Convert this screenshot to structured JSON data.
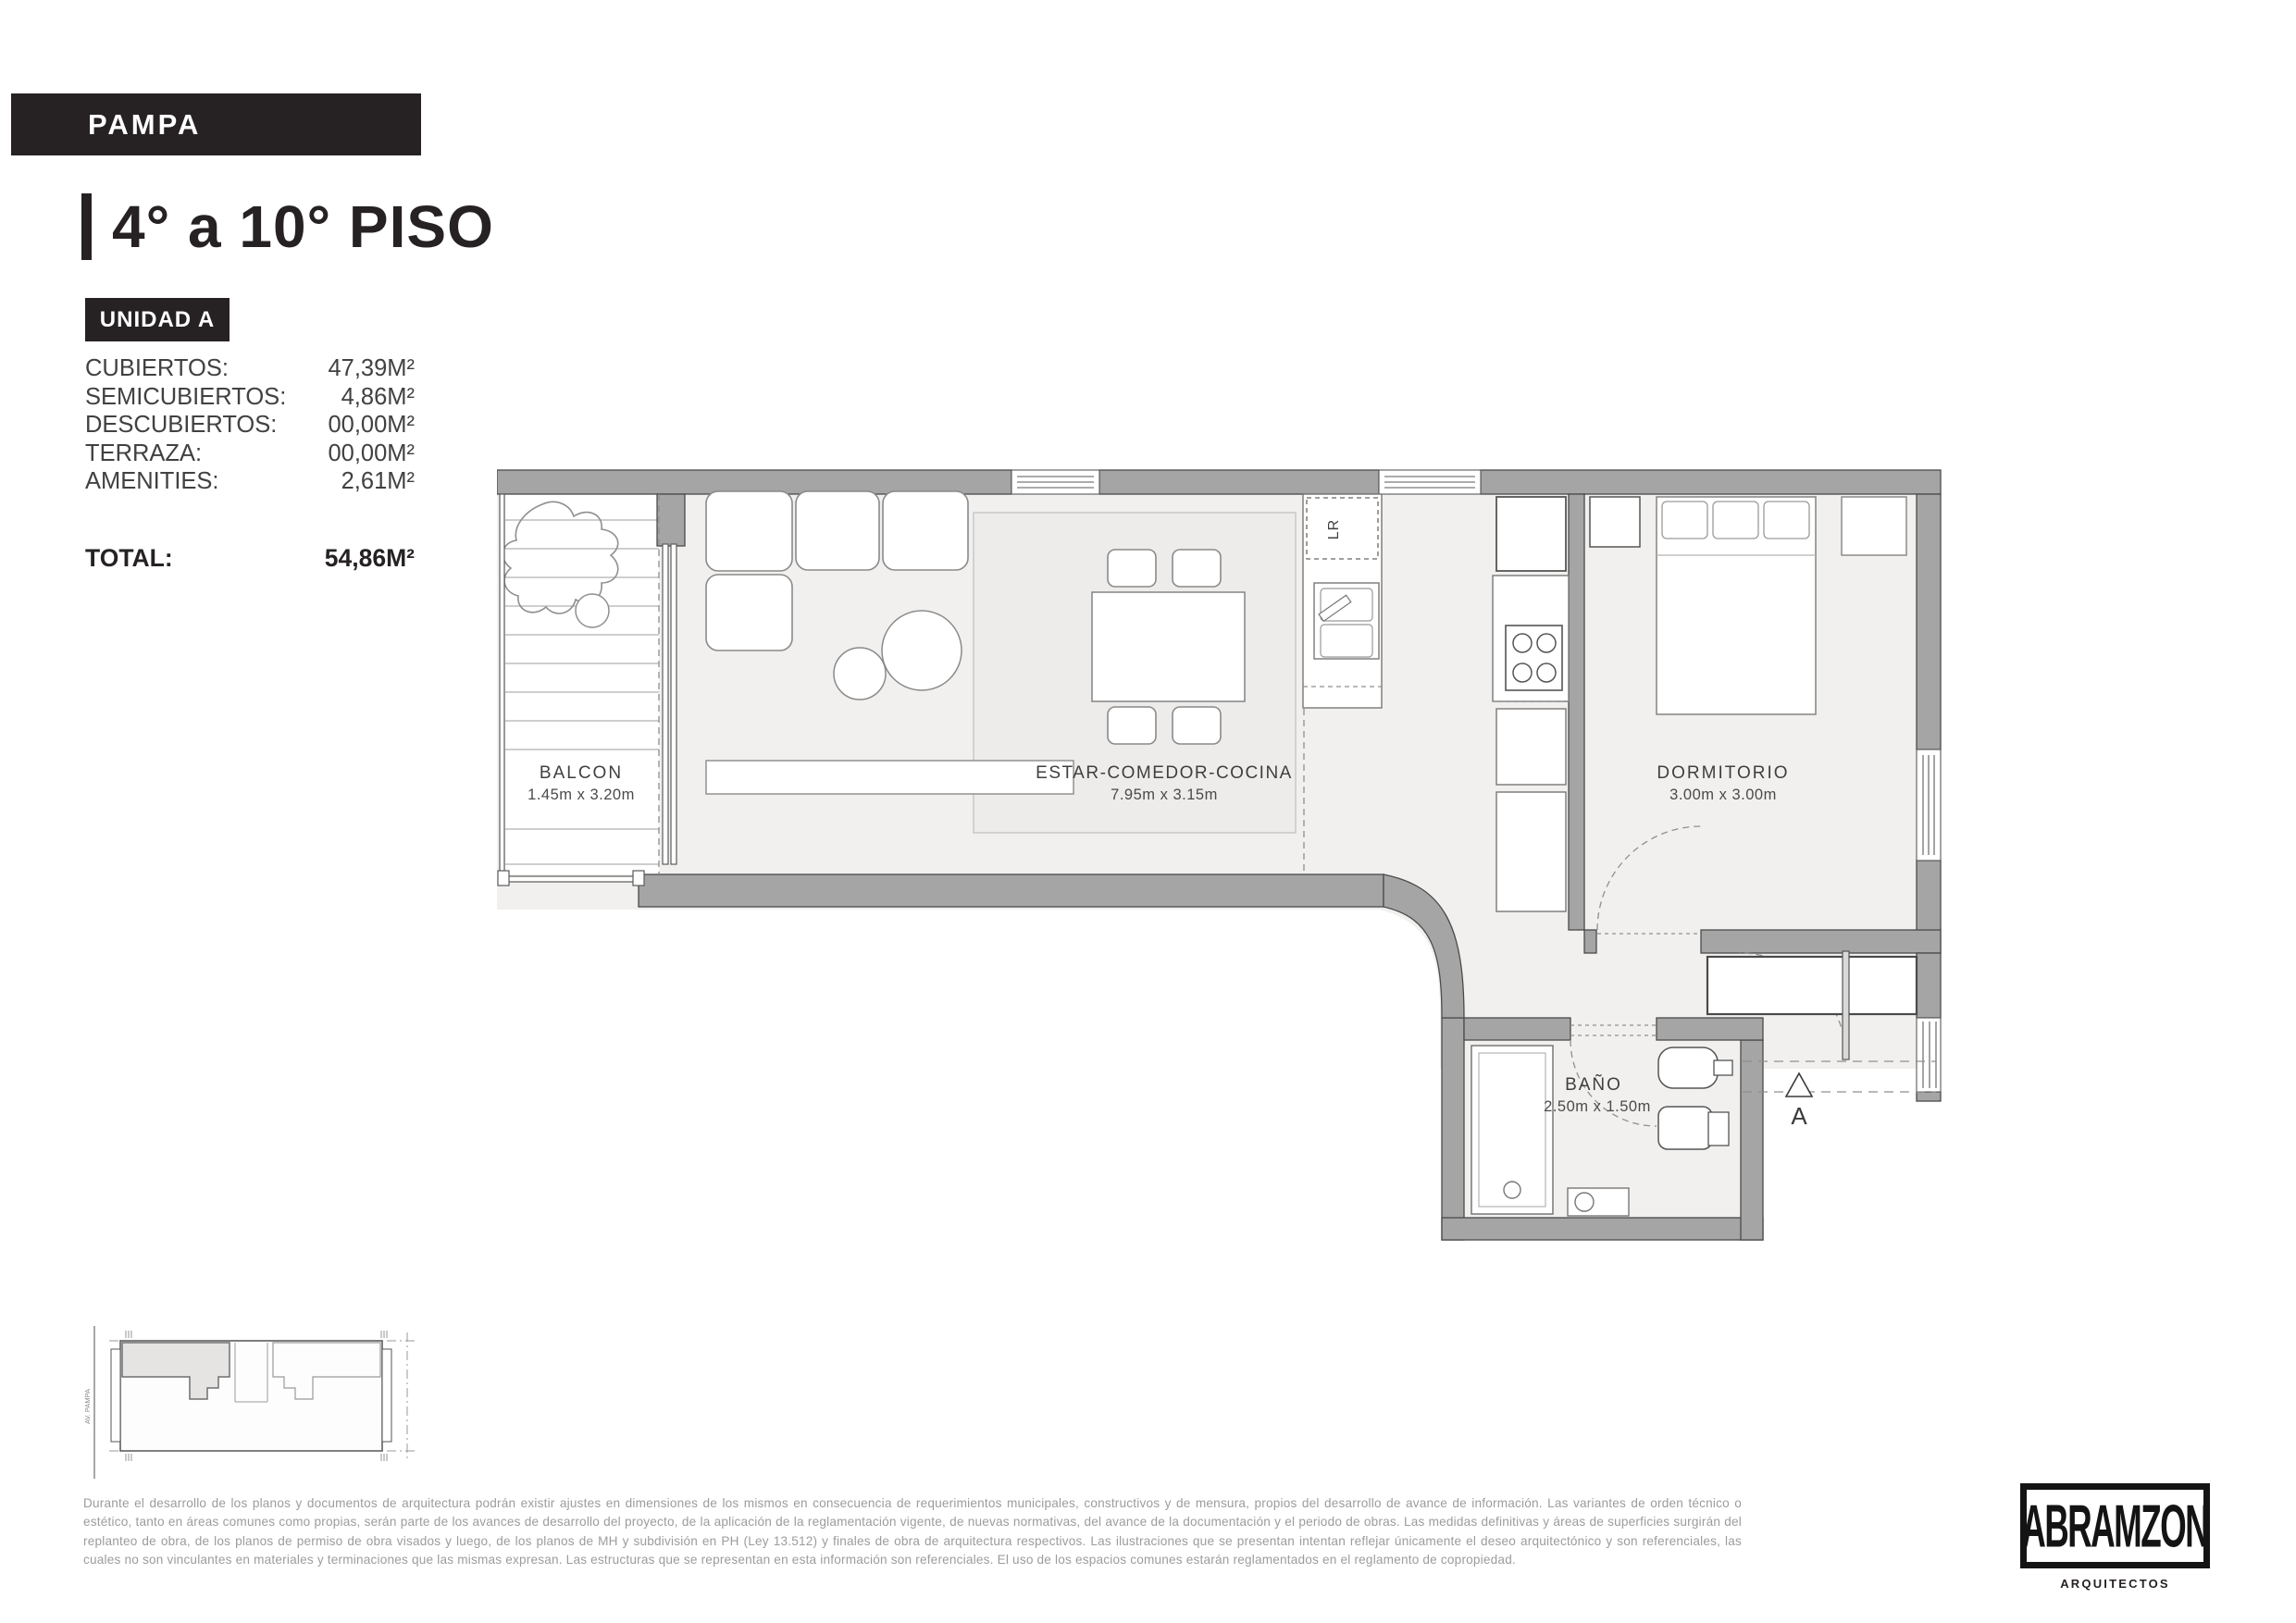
{
  "header": {
    "project": "PAMPA",
    "title": "4° a 10° PISO",
    "unit_badge": "UNIDAD A"
  },
  "areas": {
    "rows": [
      {
        "label": "CUBIERTOS:",
        "value": "47,39M²"
      },
      {
        "label": "SEMICUBIERTOS:",
        "value": "4,86M²"
      },
      {
        "label": "DESCUBIERTOS:",
        "value": "00,00M²"
      },
      {
        "label": "TERRAZA:",
        "value": "00,00M²"
      },
      {
        "label": "AMENITIES:",
        "value": "2,61M²"
      }
    ],
    "total": {
      "label": "TOTAL:",
      "value": "54,86M²"
    }
  },
  "plan": {
    "rooms": [
      {
        "name": "BALCON",
        "dims": "1.45m x 3.20m"
      },
      {
        "name": "ESTAR-COMEDOR-COCINA",
        "dims": "7.95m x 3.15m"
      },
      {
        "name": "DORMITORIO",
        "dims": "3.00m x 3.00m"
      },
      {
        "name": "BAÑO",
        "dims": "2.50m x 1.50m"
      }
    ],
    "laundry_label": "LR",
    "section_marker": "A"
  },
  "keyplan": {
    "street_label": "AV. PAMPA"
  },
  "disclaimer": {
    "text": "Durante el desarrollo de los planos y documentos de arquitectura podrán existir ajustes en dimensiones de los mismos en consecuencia de requerimientos municipales, constructivos y de mensura, propios del desarrollo de avance de información. Las variantes de orden técnico o estético, tanto en áreas comunes como propias, serán parte de los avances de desarrollo del proyecto, de la aplicación de la reglamentación vigente, de nuevas normativas,  del avance de la documentación y el periodo de obras.  Las medidas definitivas y áreas de superficies surgirán del replanteo de obra, de los planos de permiso de obra visados y luego, de los planos de MH y subdivisión en PH (Ley 13.512) y finales de obra de arquitectura respectivos. Las ilustraciones que se presentan intentan reflejar únicamente el deseo arquitectónico y son referenciales, las cuales no son vinculantes en materiales y terminaciones que las mismas expresan. Las estructuras que se representan en esta información son referenciales. El uso de los espacios comunes estarán reglamentados en el reglamento de copropiedad."
  },
  "logo": {
    "name": "ABRAMZON",
    "subtitle": "ARQUITECTOS"
  },
  "colors": {
    "accent_dark": "#262223",
    "wall_gray": "#a5a5a5",
    "floor_gray": "#f1f0ee"
  }
}
